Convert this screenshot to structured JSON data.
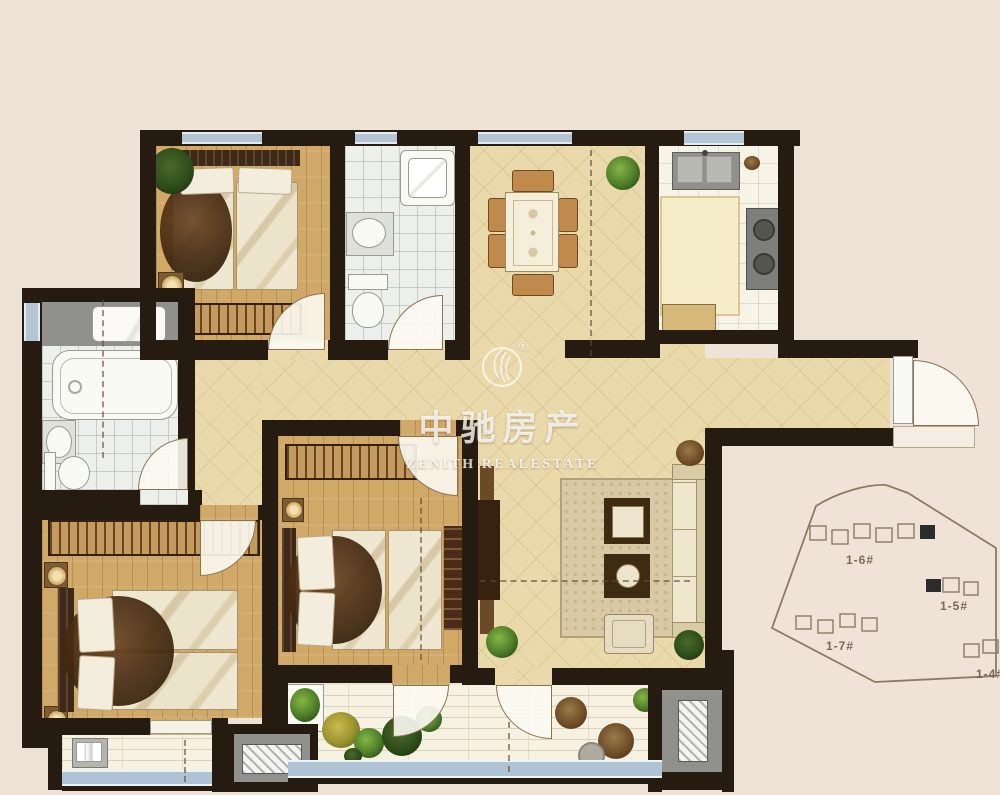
{
  "watermark": {
    "registered": "®",
    "title": "中驰房产",
    "subtitle": "ZENITH REALESTATE"
  },
  "site_plan": {
    "building_labels": [
      "1-6#",
      "1-5#",
      "1-7#",
      "1-4#"
    ]
  },
  "colors": {
    "background": "#efe3d8",
    "wall": "#251b10",
    "wood_floor": "#d0a868",
    "tile_floor": "#ead9ab",
    "bath_floor": "#edf0ea",
    "balcony_floor": "#f6f1e1",
    "window_glass": "#b3c4d4",
    "wardrobe_hatch": "#c49a5e",
    "watermark_text": "#ffffff",
    "site_plan_line": "#8b7a64"
  }
}
